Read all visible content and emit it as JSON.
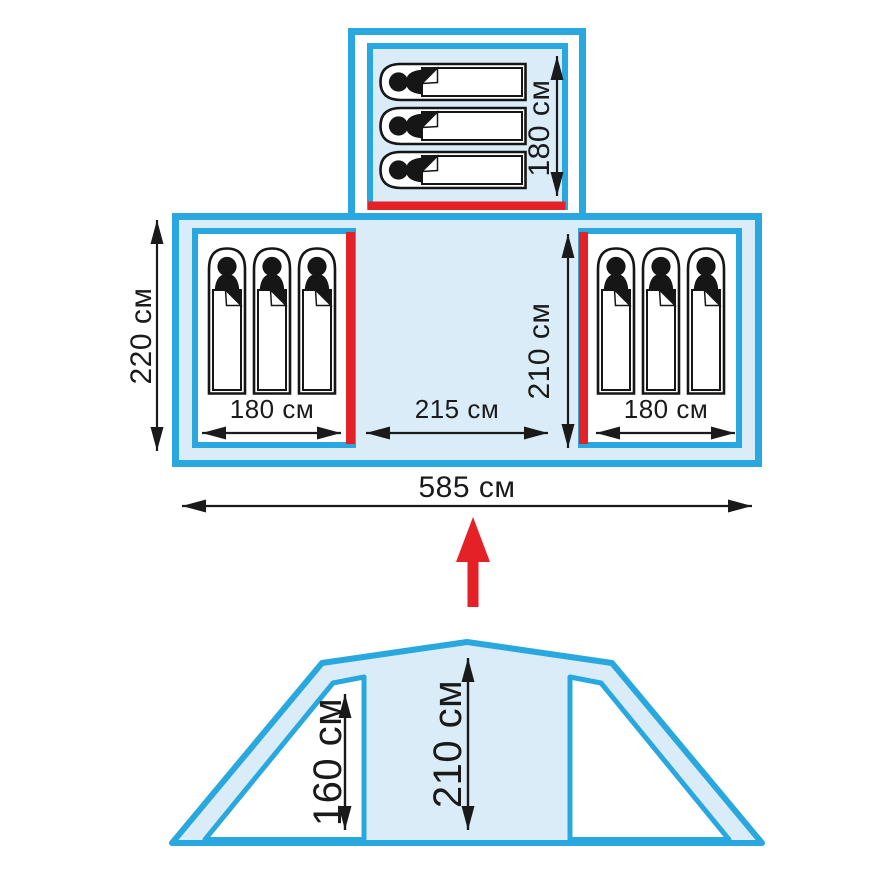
{
  "page": {
    "description": "Tent dimensions diagram: floor plan with three 3-person sleeping rooms and front elevation view"
  },
  "colors": {
    "outline_blue": "#29A8DF",
    "fill_light_blue": "#DAECF8",
    "door_red": "#E32126",
    "dimension_black": "#1A1A1A",
    "room_white": "#FFFFFF"
  },
  "floor_plan": {
    "overall_width": "585 см",
    "side_section_depth": "220 см",
    "top_room": {
      "length": "180 см",
      "sleeping_bags": 3
    },
    "left_room": {
      "width": "180 см",
      "sleeping_bags": 3
    },
    "right_room": {
      "width": "180 см",
      "sleeping_bags": 3
    },
    "center_area": {
      "width": "215 см",
      "depth": "210 см"
    }
  },
  "elevation": {
    "side_wall_height": "160 см",
    "ridge_height": "210 см"
  }
}
